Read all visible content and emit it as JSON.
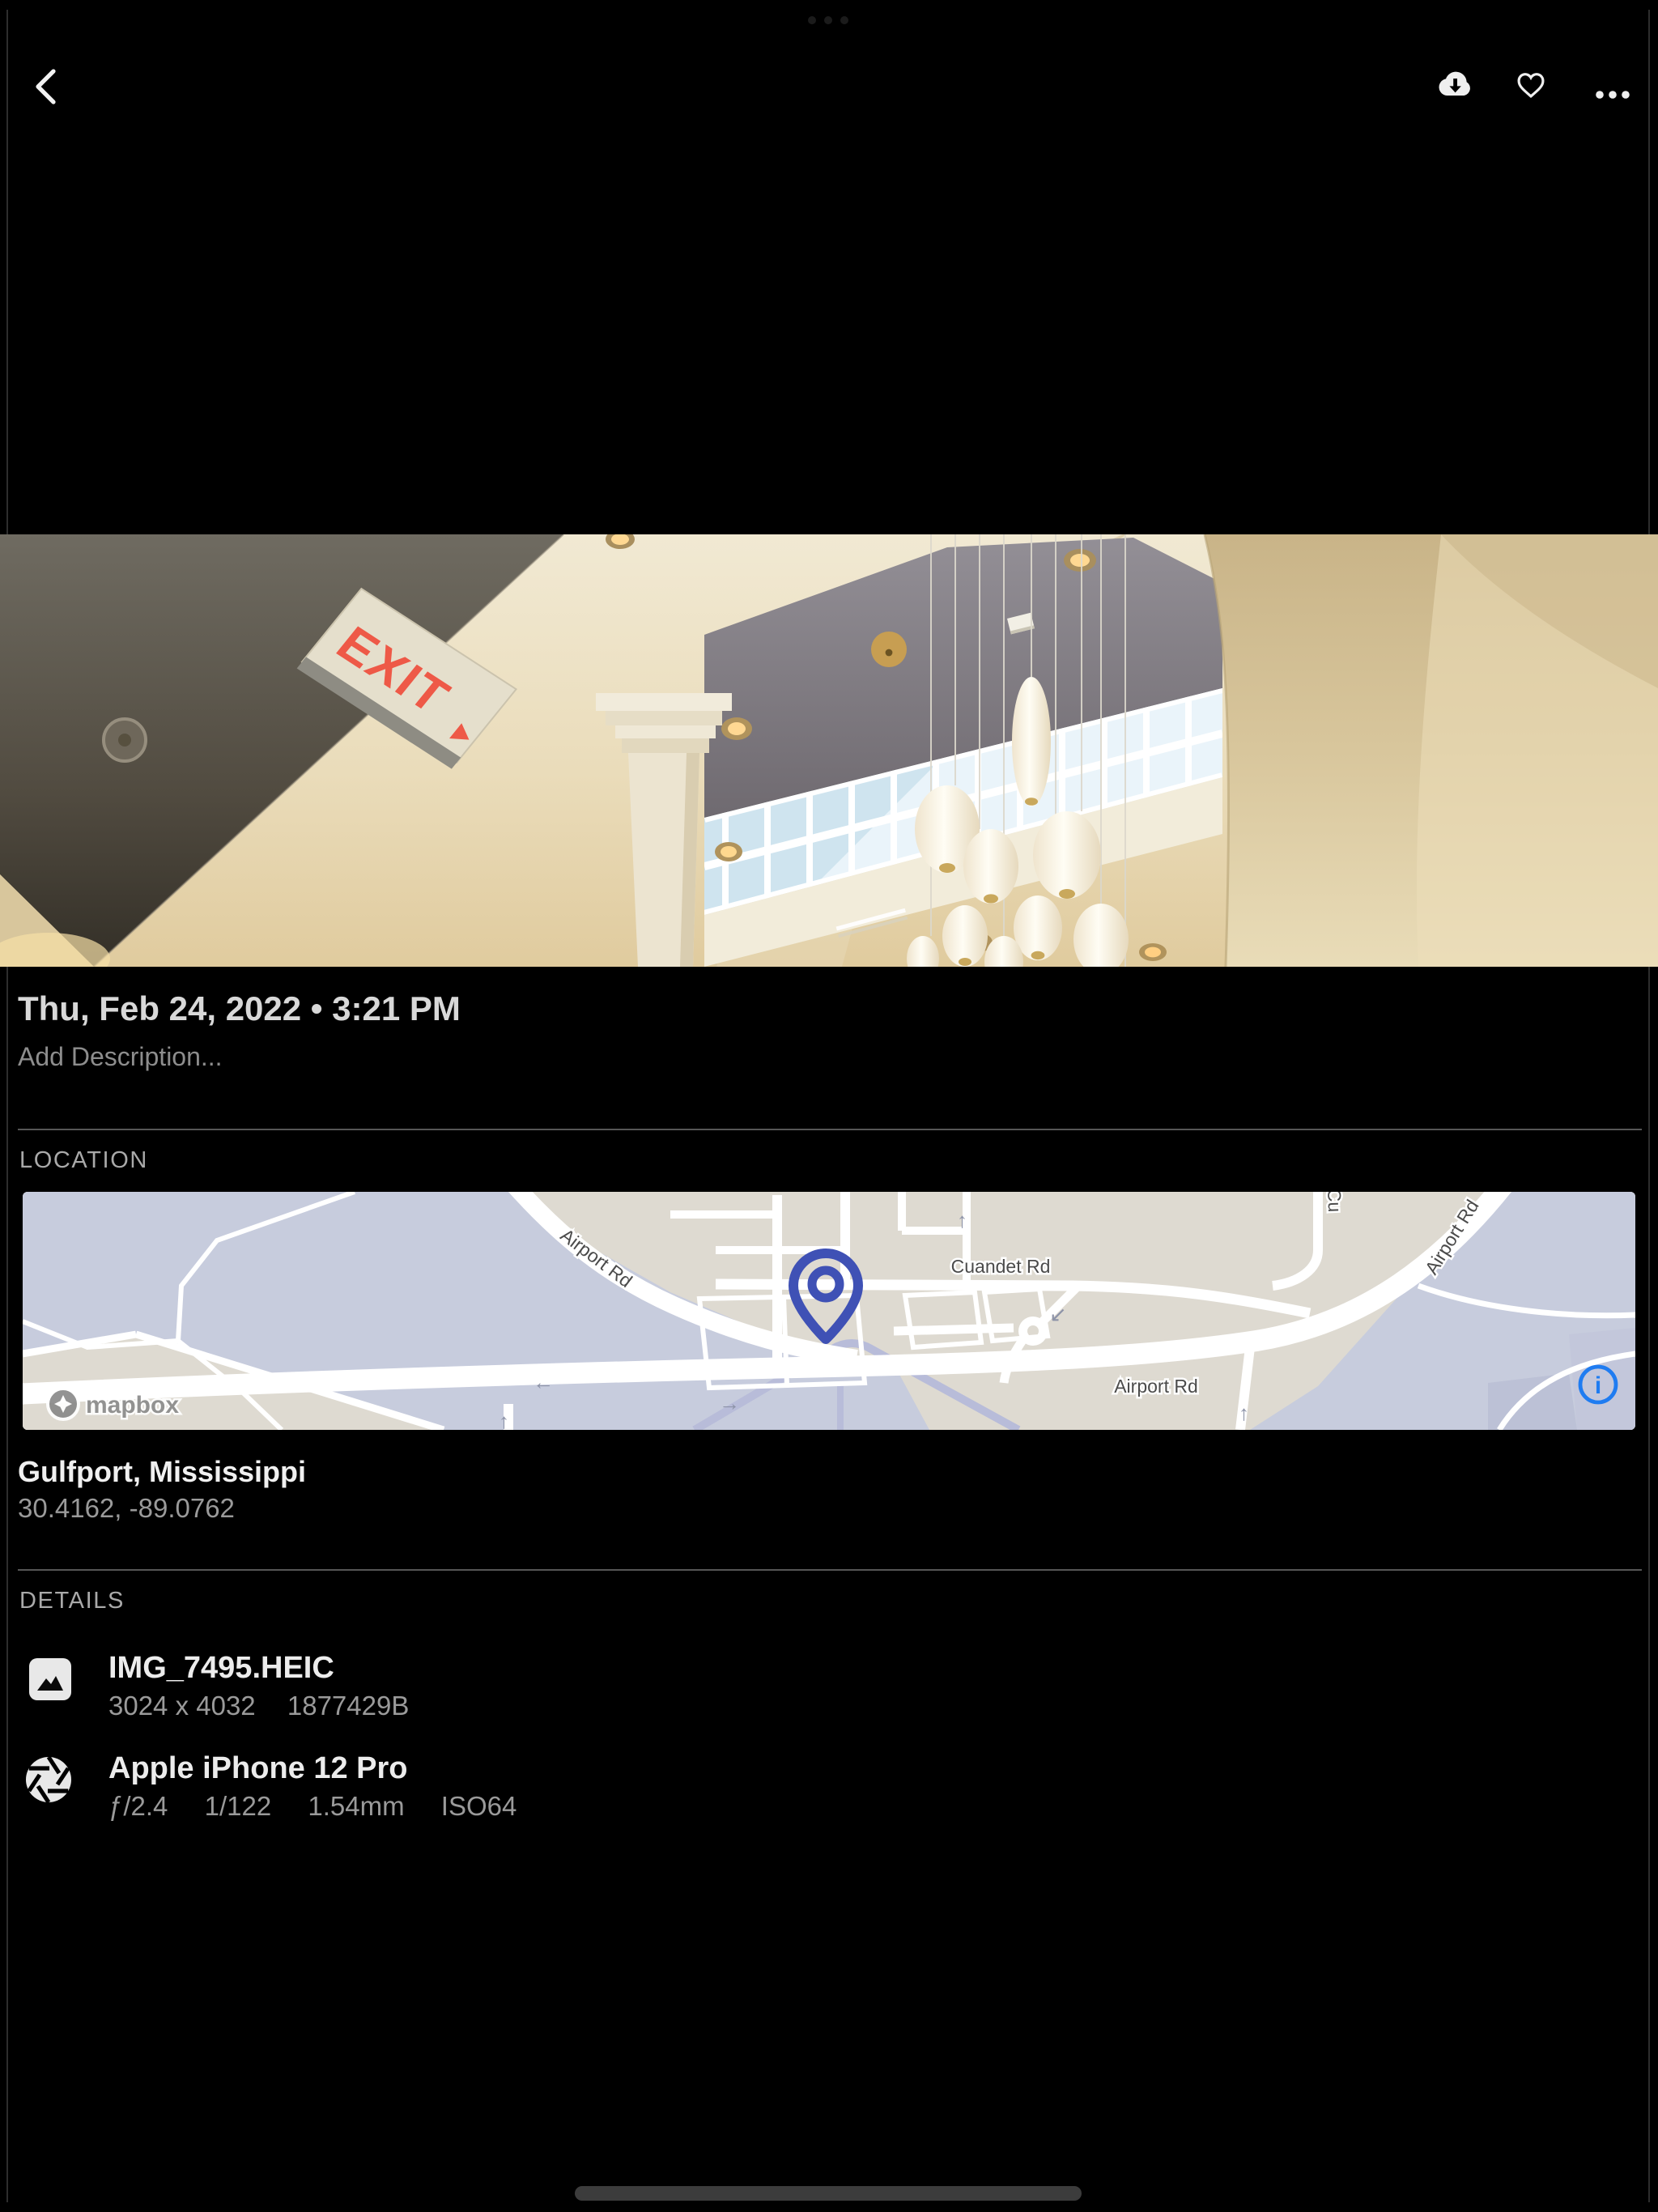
{
  "colors": {
    "background": "#000000",
    "pin_blue": "#3f51b5",
    "info_blue": "#1f7cf1",
    "exit_red": "#ee5947",
    "map_land": "#dedad1",
    "map_water": "#c7ccdd",
    "text_primary": "#ececec",
    "text_secondary": "#9a9a9a"
  },
  "top_bar": {
    "back_icon": "chevron-left",
    "download_icon": "cloud-download",
    "favorite_icon": "heart-outline",
    "more_icon": "ellipsis"
  },
  "photo": {
    "exit_sign_text": "EXIT"
  },
  "meta": {
    "date": "Thu, Feb 24, 2022 • 3:21 PM",
    "description_placeholder": "Add Description..."
  },
  "location": {
    "header": "LOCATION",
    "place": "Gulfport, Mississippi",
    "coordinates": "30.4162, -89.0762",
    "map": {
      "provider_wordmark": "mapbox",
      "labels": {
        "airport_rd_diagonal": "Airport Rd",
        "cuandet_rd": "Cuandet Rd",
        "airport_rd_bottom": "Airport Rd",
        "airport_rd_right_partial": "Airport Rd",
        "cross_street_partial": "Cu"
      },
      "info_icon": "i"
    }
  },
  "details": {
    "header": "DETAILS",
    "file": {
      "name": "IMG_7495.HEIC",
      "dimensions": "3024 x 4032",
      "size": "1877429B"
    },
    "camera": {
      "name": "Apple iPhone 12 Pro",
      "aperture": "ƒ/2.4",
      "shutter": "1/122",
      "focal_length": "1.54mm",
      "iso": "ISO64"
    }
  }
}
